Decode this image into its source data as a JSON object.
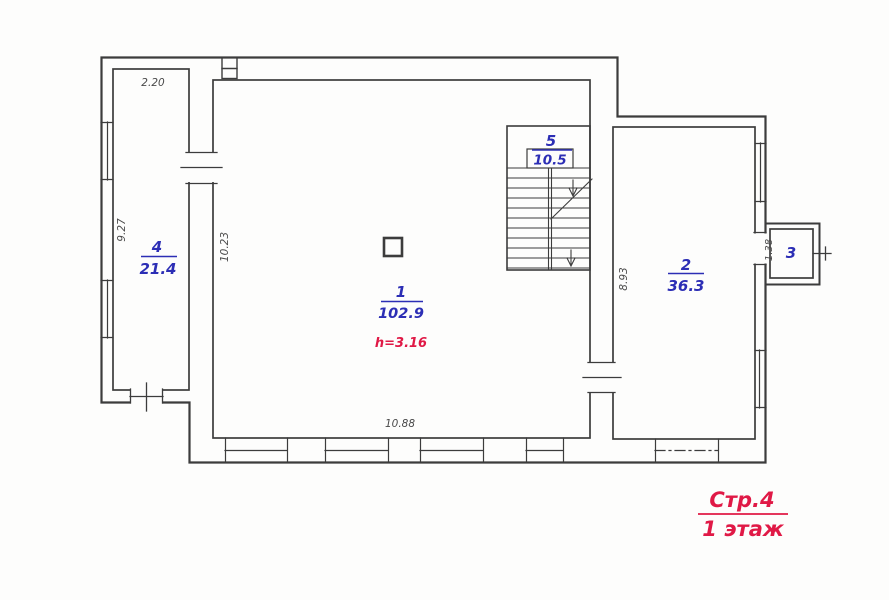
{
  "drawing": {
    "rooms": [
      {
        "number": "1",
        "area": "102.9",
        "height_note": "h=3.16"
      },
      {
        "number": "2",
        "area": "36.3"
      },
      {
        "number": "3"
      },
      {
        "number": "4",
        "area": "21.4"
      },
      {
        "number": "5",
        "area": "10.5"
      }
    ],
    "dimensions": {
      "room4_top_width": "2.20",
      "room4_left_height": "9.27",
      "room1_left_height": "10.23",
      "room2_left_height": "8.93",
      "room1_bottom_width": "10.88",
      "balcony_depth": "1.38"
    },
    "title_block": {
      "page": "Стр.4",
      "floor": "1 этаж"
    },
    "colors": {
      "wall": "#3c3c3c",
      "room_label": "#2c2eb5",
      "accent_red": "#e01946",
      "dimension": "#4a4a4a",
      "paper": "#fdfdfc"
    }
  }
}
